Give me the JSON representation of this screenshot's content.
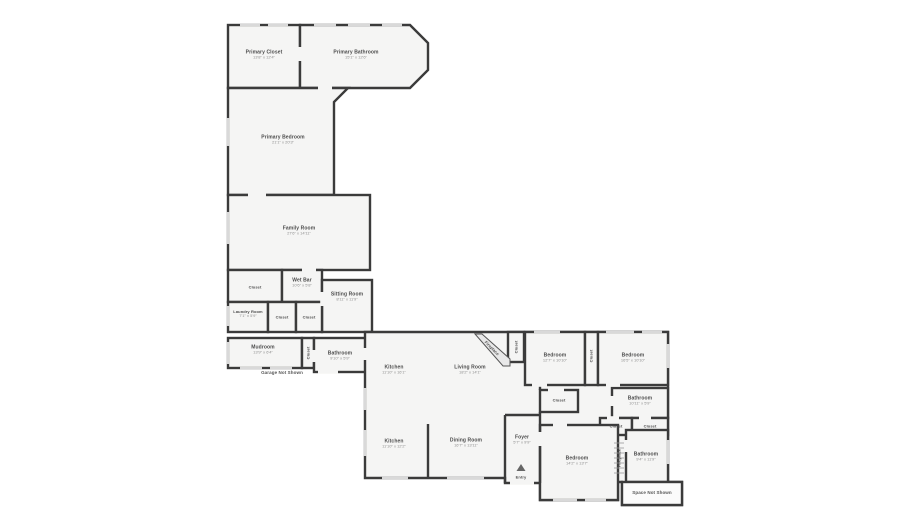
{
  "colors": {
    "wall": "#3b3b3b",
    "room_fill": "#f5f5f4",
    "window": "#d9d9d9",
    "label_text": "#4c4c4c",
    "dims_text": "#8f8f8f"
  },
  "rooms": [
    {
      "name": "Primary Closet",
      "dims": "13'8\" x 12'4\""
    },
    {
      "name": "Primary Bathroom",
      "dims": "15'1\" x 12'6\""
    },
    {
      "name": "Primary Bedroom",
      "dims": "21'1\" x 20'3\""
    },
    {
      "name": "Family Room",
      "dims": "27'6\" x 14'11\""
    },
    {
      "name": "Closet",
      "dims": ""
    },
    {
      "name": "Wet Bar",
      "dims": "10'6\" x 5'8\""
    },
    {
      "name": "Sitting Room",
      "dims": "8'11\" x 11'9\""
    },
    {
      "name": "Laundry Room",
      "dims": "7'1\" x 5'9\""
    },
    {
      "name": "Closet",
      "dims": ""
    },
    {
      "name": "Closet",
      "dims": ""
    },
    {
      "name": "Mudroom",
      "dims": "13'9\" x 6'4\""
    },
    {
      "name": "Closet",
      "dims": ""
    },
    {
      "name": "Bathroom",
      "dims": "9'10\" x 5'9\""
    },
    {
      "name": "Kitchen",
      "dims": "11'10\" x 16'1\""
    },
    {
      "name": "Living Room",
      "dims": "18'2\" x 14'1\""
    },
    {
      "name": "Fireplace",
      "dims": ""
    },
    {
      "name": "Closet",
      "dims": ""
    },
    {
      "name": "Bedroom",
      "dims": "12'7\" x 10'10\""
    },
    {
      "name": "Closet",
      "dims": ""
    },
    {
      "name": "Bedroom",
      "dims": "16'5\" x 10'10\""
    },
    {
      "name": "Closet",
      "dims": ""
    },
    {
      "name": "Bathroom",
      "dims": "10'11\" x 5'9\""
    },
    {
      "name": "Closet",
      "dims": ""
    },
    {
      "name": "Closet",
      "dims": ""
    },
    {
      "name": "Kitchen",
      "dims": "11'10\" x 12'2\""
    },
    {
      "name": "Dining Room",
      "dims": "16'7\" x 13'11\""
    },
    {
      "name": "Foyer",
      "dims": "5'7\" x 9'9\""
    },
    {
      "name": "Bedroom",
      "dims": "14'2\" x 13'7\""
    },
    {
      "name": "Fireplace",
      "dims": ""
    },
    {
      "name": "Bathroom",
      "dims": "9'4\" x 11'9\""
    }
  ],
  "annotations": {
    "garage": "Garage Not Shown",
    "space": "Space Not Shown",
    "entry": "Entry"
  }
}
